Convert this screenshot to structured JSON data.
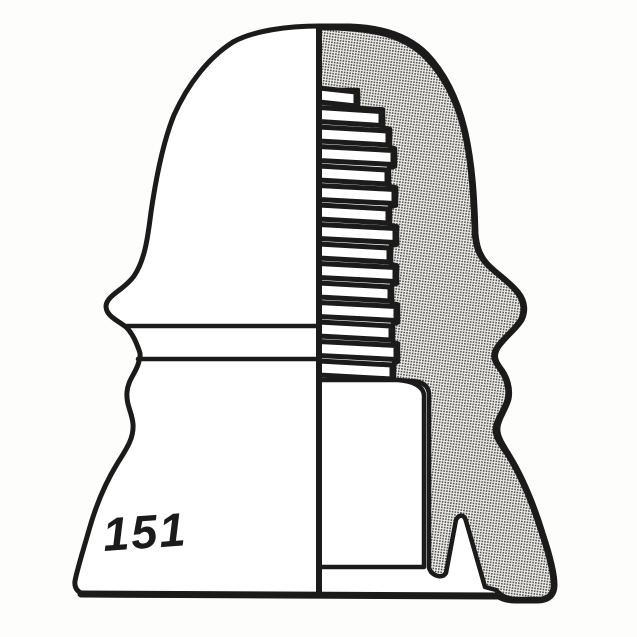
{
  "figure": {
    "label": "151",
    "description": "insulator profile and cross-section drawing"
  },
  "colors": {
    "line": "#1b1b1b",
    "fill": "#ffffff",
    "background": "#fdfdfc",
    "hatch_dot": "#474747",
    "hatch_bg": "#f2f1ed"
  }
}
